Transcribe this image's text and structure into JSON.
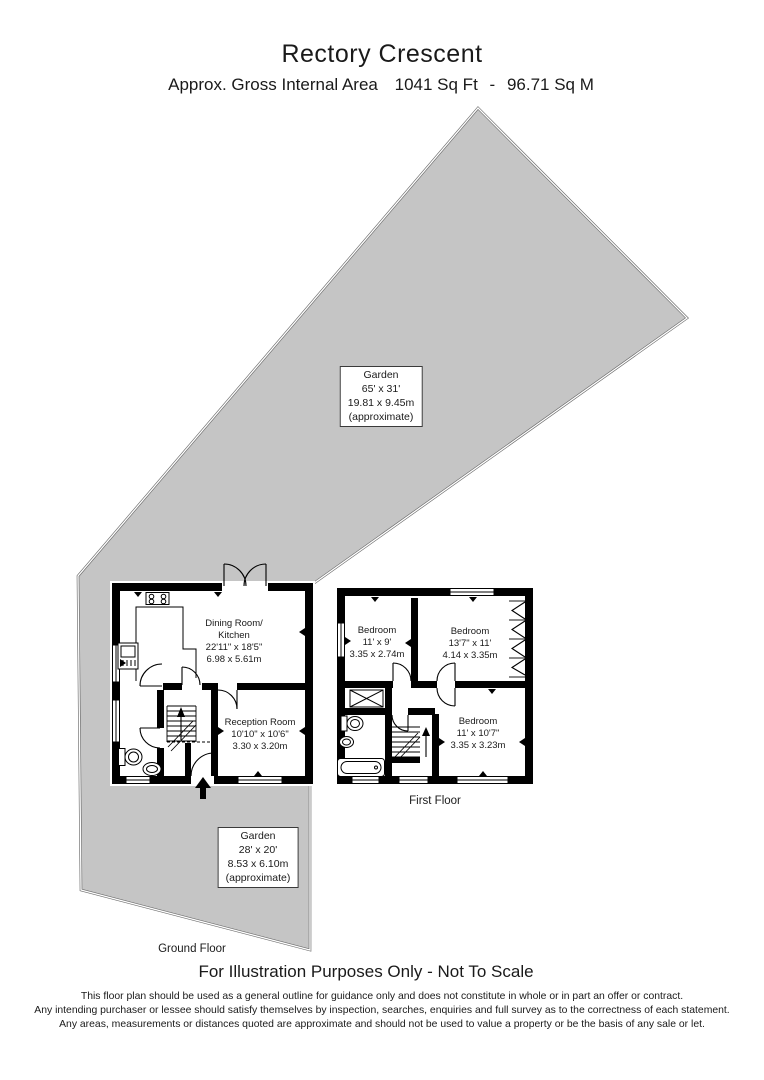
{
  "header": {
    "title": "Rectory Crescent",
    "area_label": "Approx. Gross Internal Area",
    "area_sqft": "1041 Sq Ft",
    "separator": "-",
    "area_sqm": "96.71 Sq M"
  },
  "gardens": {
    "rear": {
      "lines": [
        "Garden",
        "65' x 31'",
        "19.81 x 9.45m",
        "(approximate)"
      ]
    },
    "front": {
      "lines": [
        "Garden",
        "28' x 20'",
        "8.53 x 6.10m",
        "(approximate)"
      ]
    }
  },
  "ground_floor": {
    "label": "Ground Floor",
    "rooms": {
      "dining_kitchen": {
        "lines": [
          "Dining Room/",
          "Kitchen",
          "22'11\" x 18'5\"",
          "6.98 x 5.61m"
        ]
      },
      "reception": {
        "lines": [
          "Reception Room",
          "10'10\" x 10'6\"",
          "3.30 x 3.20m"
        ]
      }
    }
  },
  "first_floor": {
    "label": "First Floor",
    "rooms": {
      "bedroom1": {
        "lines": [
          "Bedroom",
          "11' x 9'",
          "3.35 x 2.74m"
        ]
      },
      "bedroom2": {
        "lines": [
          "Bedroom",
          "13'7\" x 11'",
          "4.14 x 3.35m"
        ]
      },
      "bedroom3": {
        "lines": [
          "Bedroom",
          "11' x 10'7\"",
          "3.35 x 3.23m"
        ]
      }
    }
  },
  "footer": {
    "notice": "For Illustration Purposes Only - Not To Scale",
    "disclaimer": [
      "This floor plan should be used as a general outline for guidance only and does not constitute in whole or in part an offer or contract.",
      "Any intending purchaser or lessee should satisfy themselves by inspection, searches, enquiries and full survey as to the correctness of each statement.",
      "Any areas, measurements or distances quoted are approximate and should not be used to value a property or be the basis of any sale or let."
    ]
  },
  "colors": {
    "background": "#ffffff",
    "garden_fill": "#c5c5c5",
    "garden_border": "#6b6b6b",
    "wall": "#000000"
  }
}
